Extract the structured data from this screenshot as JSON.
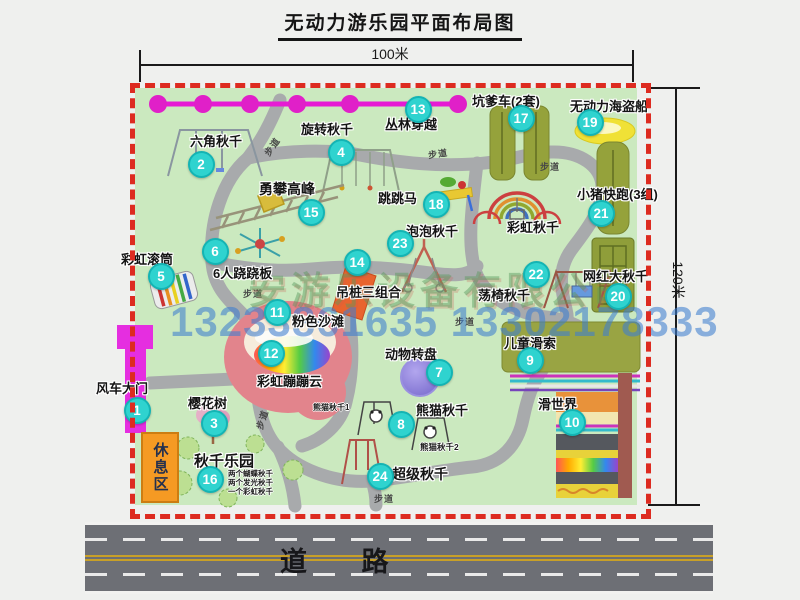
{
  "title": "无动力游乐园平面布局图",
  "dimension_width": "100米",
  "dimension_height": "120米",
  "road_label": "道   路",
  "rest_zone_label": "休息区",
  "path_label": "步道",
  "rainbow_swing_label": "彩虹秋千",
  "watermark": {
    "company": "安游乐设备有限公司",
    "phone": "13233861635 13302178333"
  },
  "attractions": [
    {
      "num": "1",
      "label": "风车大门"
    },
    {
      "num": "2",
      "label": "六角秋千"
    },
    {
      "num": "3",
      "label": "樱花树"
    },
    {
      "num": "4",
      "label": "旋转秋千"
    },
    {
      "num": "5",
      "label": "彩虹滚筒"
    },
    {
      "num": "6",
      "label": "6人跷跷板"
    },
    {
      "num": "7",
      "label": "动物转盘"
    },
    {
      "num": "8",
      "label": "熊猫秋千",
      "sub": [
        "熊猫秋千1",
        "熊猫秋千2"
      ]
    },
    {
      "num": "9",
      "label": "儿童滑索"
    },
    {
      "num": "10",
      "label": "滑世界"
    },
    {
      "num": "11",
      "label": "粉色沙滩"
    },
    {
      "num": "12",
      "label": "彩虹蹦蹦云"
    },
    {
      "num": "13",
      "label": "丛林穿越"
    },
    {
      "num": "14",
      "label": "吊桩三组合"
    },
    {
      "num": "15",
      "label": "勇攀高峰"
    },
    {
      "num": "16",
      "label": "秋千乐园",
      "sub": [
        "两个蝴蝶秋千",
        "两个发光秋千",
        "一个彩虹秋千"
      ]
    },
    {
      "num": "17",
      "label": "坑爹车(2套)"
    },
    {
      "num": "18",
      "label": "跳跳马"
    },
    {
      "num": "19",
      "label": "无动力海盗船"
    },
    {
      "num": "20",
      "label": "网红大秋千"
    },
    {
      "num": "21",
      "label": "小猪快跑(3组)"
    },
    {
      "num": "22",
      "label": "荡椅秋千"
    },
    {
      "num": "23",
      "label": "泡泡秋千"
    },
    {
      "num": "24",
      "label": "超级秋千"
    }
  ]
}
